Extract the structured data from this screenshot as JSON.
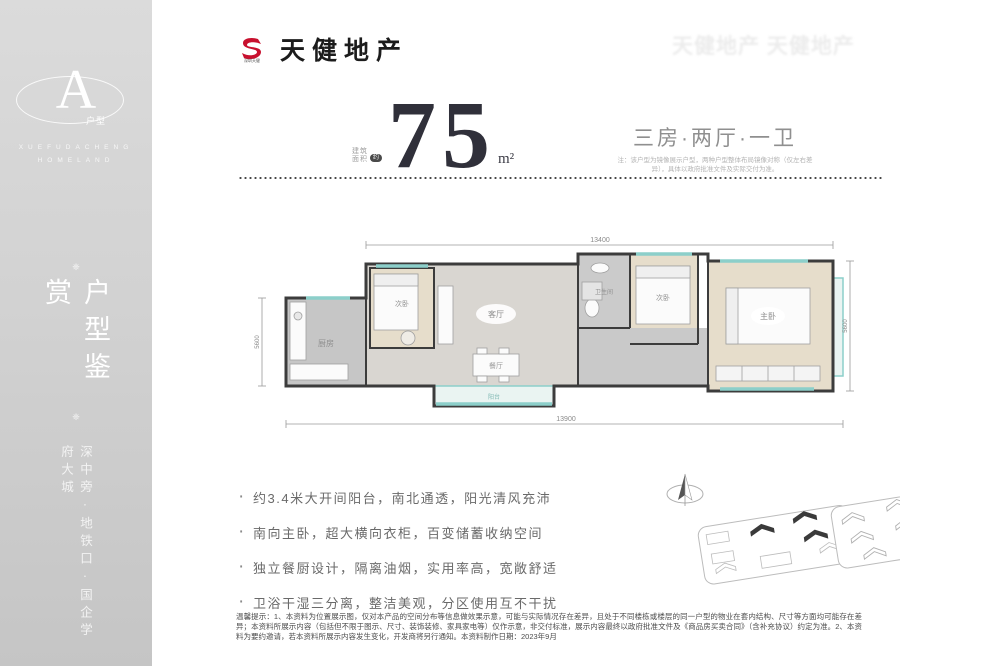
{
  "sidebar": {
    "badge": {
      "letter": "A",
      "label": "户型",
      "en_line1": "XUEFUDACHENG",
      "en_line2": "HOMELAND"
    },
    "ornament": "❈",
    "vertical_title": "户型鉴赏",
    "vertical_subtitle": "深中旁·地铁口·国企学府大城"
  },
  "header": {
    "brand_name": "天健地产",
    "brand_mark": "S",
    "brand_mark_sub": "深圳天健",
    "watermark": "天健地产 天健地产"
  },
  "headline": {
    "area_label_line1": "建筑",
    "area_label_line2": "面积",
    "area_tag": "约",
    "area_value": "75",
    "area_unit": "m²",
    "layout_type": "三房·两厅·一卫",
    "note_line1": "注：该户型为镜像展示户型，两种户型整体布局镜像对称（仅左右差",
    "note_line2": "异），具体以政府批准文件及实际交付为准。"
  },
  "floorplan": {
    "dim_top": "13400",
    "dim_bottom": "13900",
    "dim_left": "5600",
    "dim_right": "5600",
    "rooms": {
      "kitchen": "厨房",
      "bedroom1": "次卧",
      "living": "客厅",
      "dining": "餐厅",
      "bath": "卫生间",
      "bedroom2": "次卧",
      "master": "主卧",
      "balcony": "阳台"
    }
  },
  "features": {
    "items": [
      "约3.4米大开间阳台，南北通透，阳光清风充沛",
      "南向主卧，超大横向衣柜，百变储蓄收纳空间",
      "独立餐厨设计，隔离油烟，实用率高，宽敞舒适",
      "卫浴干湿三分离，整洁美观，分区使用互不干扰"
    ]
  },
  "disclaimer": "温馨提示：1、本资料为位置展示图，仅对本产品的空间分布等信息做效果示意，可能与实际情况存在差异，且处于不同楼栋或楼层的同一户型的物业在套内结构、尺寸等方面均可能存在差异；本资料所展示内容（包括但不限于图示、尺寸、装饰装修、家具家电等）仅作示意，非交付标准，展示内容最终以政府批准文件及《商品房买卖合同》（含补充协议）约定为准。2、本资料为要约邀请，若本资料所展示内容发生变化，开发商将另行通知。本资料制作日期：2023年9月"
}
